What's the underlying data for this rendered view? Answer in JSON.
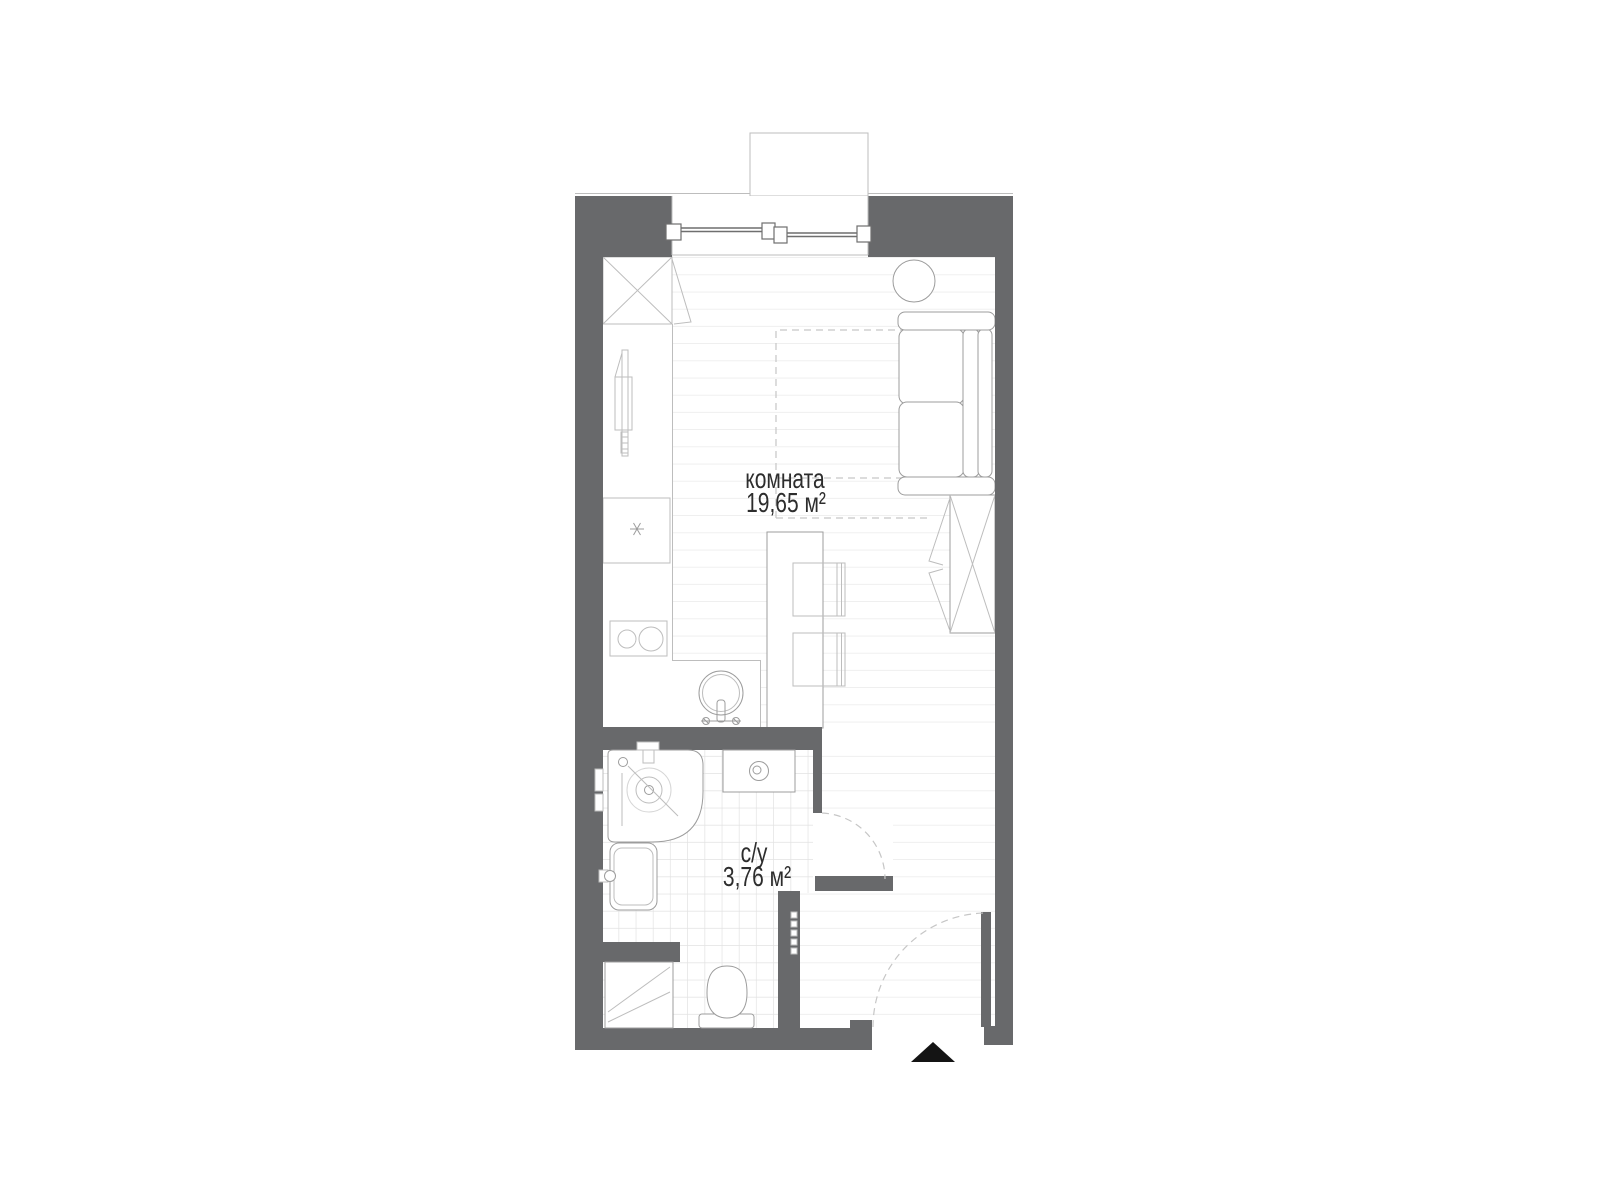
{
  "page": {
    "background": "#ffffff",
    "type": "apartment floor plan"
  },
  "colors": {
    "wall": "#68696b",
    "outline": "#9c9c9c",
    "light_outline": "#bdbdbd",
    "floor_line": "#eaeaea",
    "tile_line": "#e2e2e2",
    "dash": "#c6c6c6",
    "window_frame": "#6f6f6f",
    "text": "#2d2d2d",
    "marker": "#141414"
  },
  "plan": {
    "rooms": [
      {
        "id": "room",
        "name": "комната",
        "area": "19,65 м²"
      },
      {
        "id": "bathroom",
        "name": "с/у",
        "area": "3,76 м²"
      }
    ],
    "elements": [
      "balcony",
      "window",
      "wardrobe-top",
      "kitchen-tall-unit",
      "appliance-box",
      "cooktop",
      "kitchen-sink",
      "bar-island",
      "stool",
      "stool",
      "pouf",
      "sofa",
      "wardrobe-right",
      "bed-outline-dashed",
      "shower-tray",
      "washing-machine",
      "wash-basin",
      "water-heater-cabinet",
      "toilet",
      "bathroom-door",
      "entrance-door",
      "entrance-marker"
    ]
  }
}
